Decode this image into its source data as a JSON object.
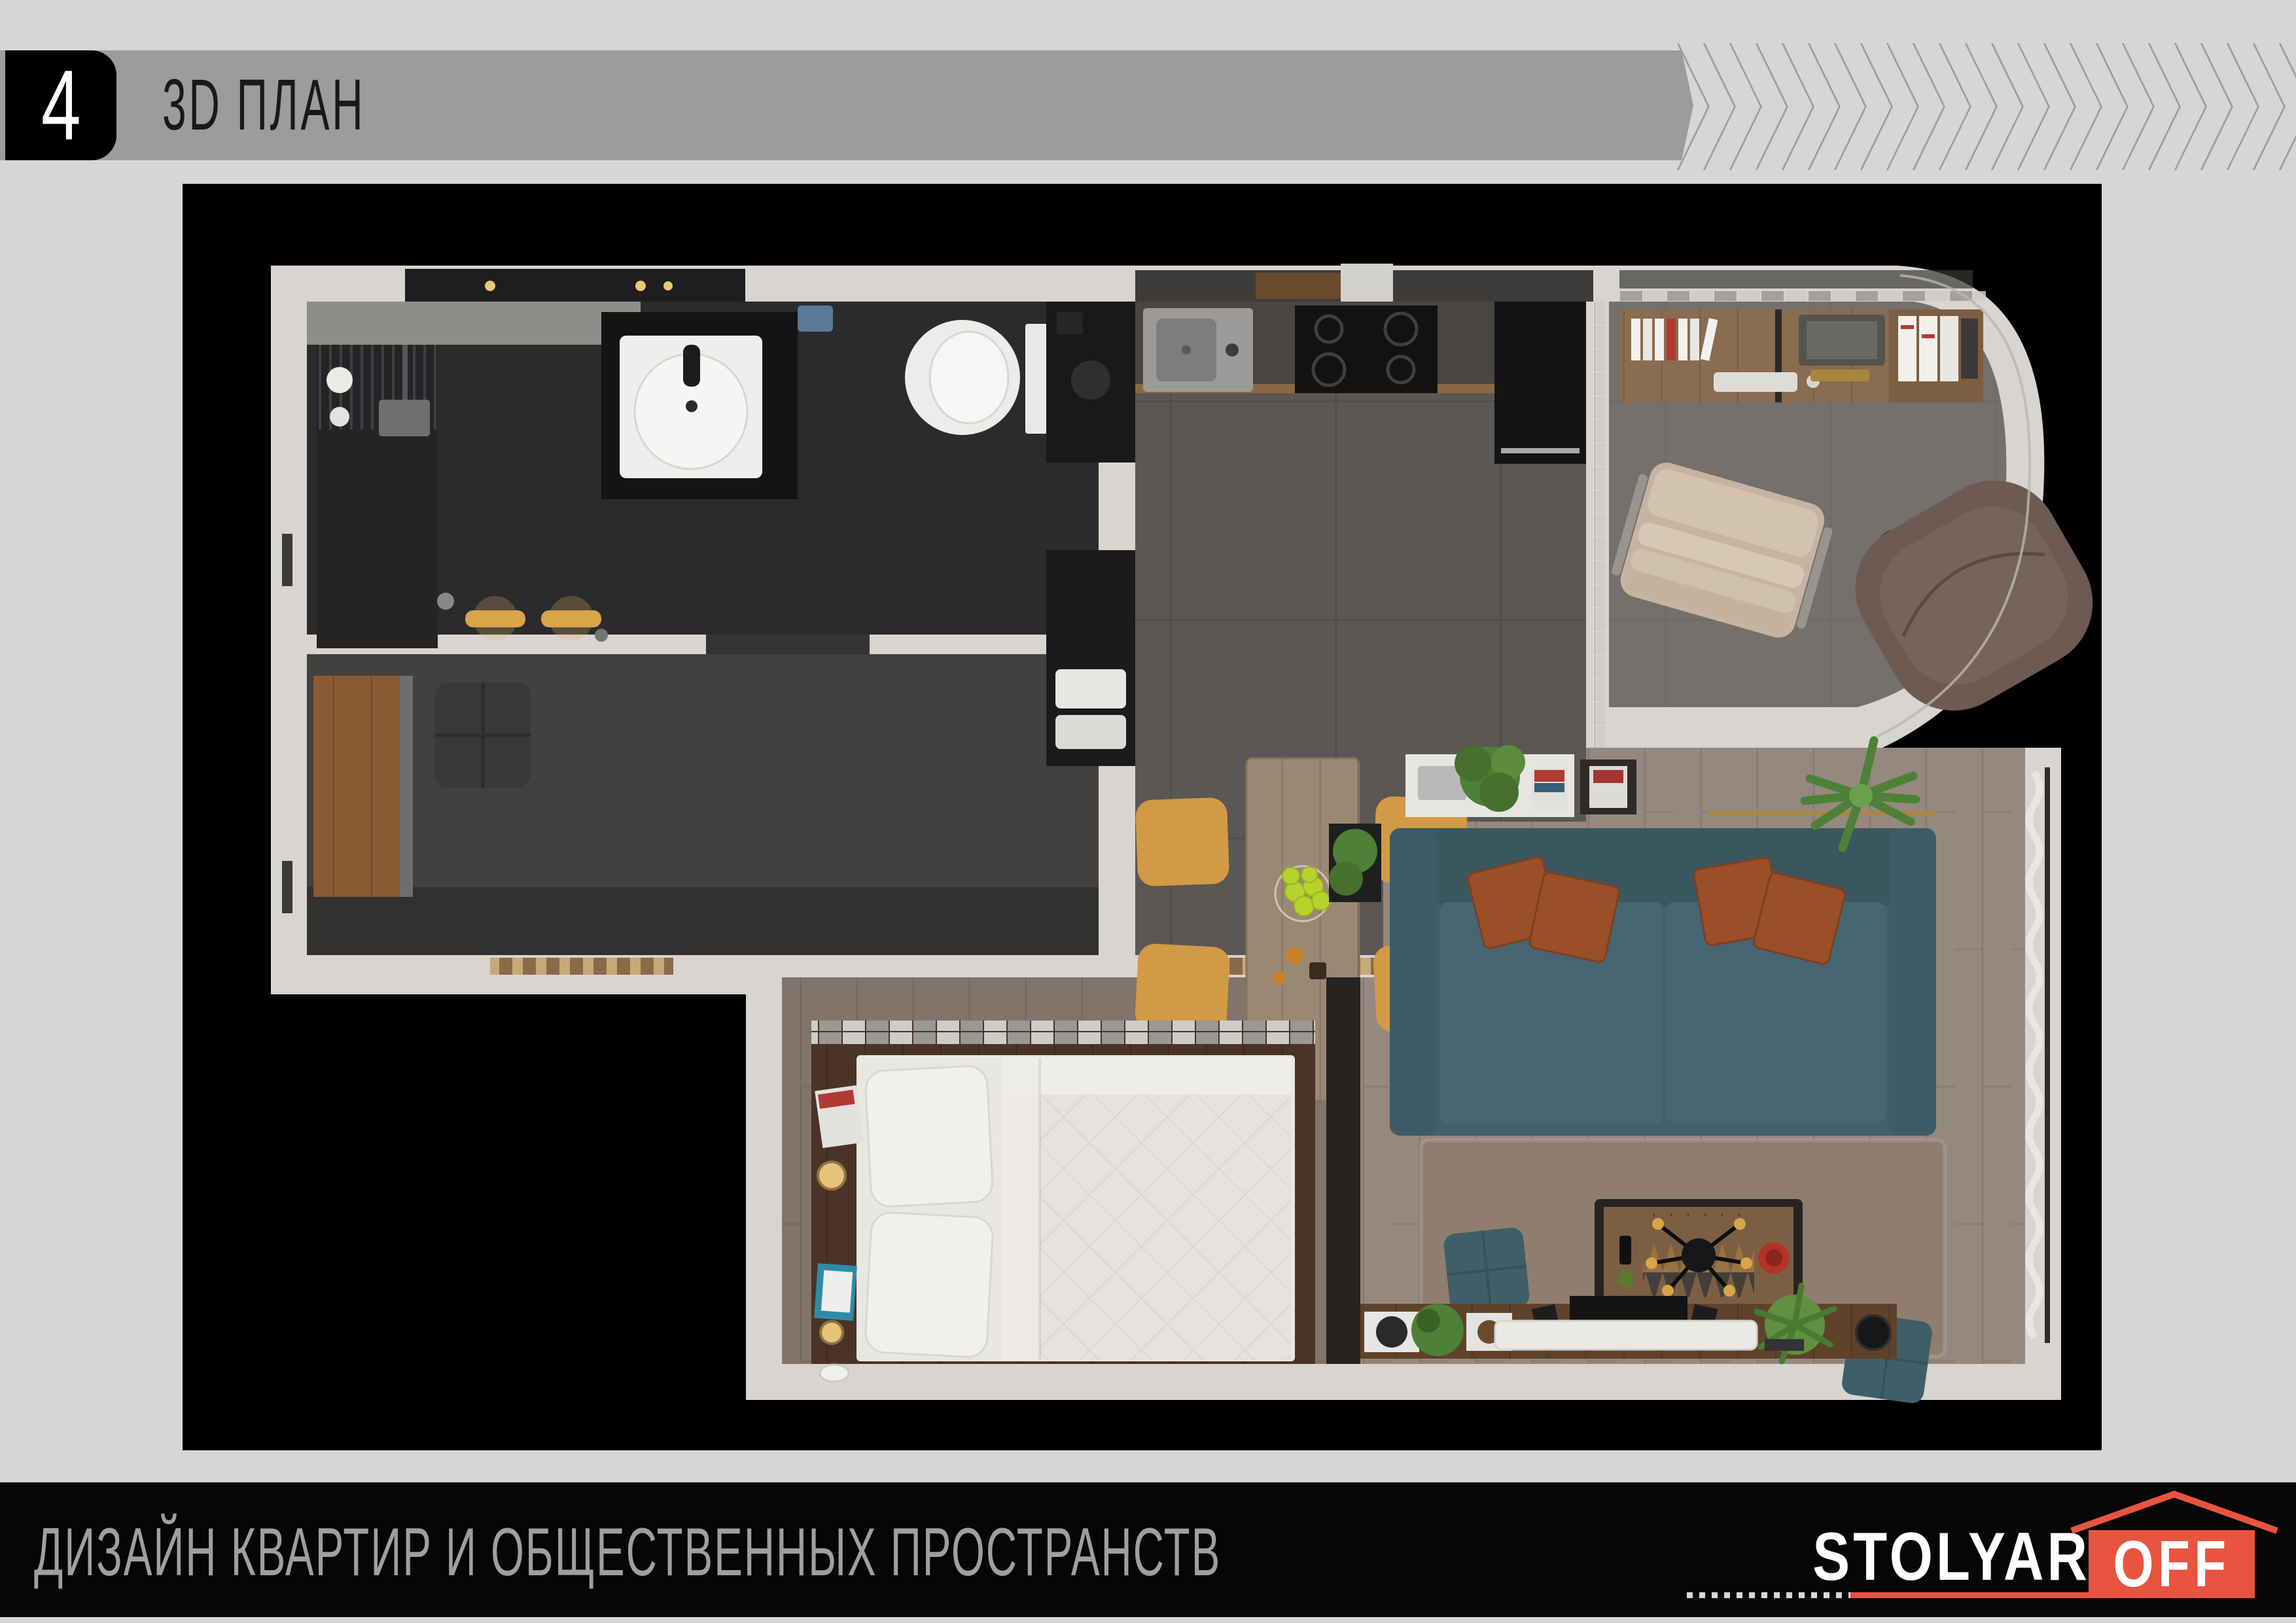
{
  "slide": {
    "number": "4",
    "title": "3D ПЛАН"
  },
  "footer": {
    "tagline": "ДИЗАЙН КВАРТИР И ОБЩЕСТВЕННЫХ ПРОСТРАНСТВ",
    "logo": {
      "name_left": "STOLYAR",
      "name_right": "OFF"
    }
  },
  "colors": {
    "page_bg": "#d6d6d6",
    "header_bar": "#9c9c9c",
    "header_number_bg": "#000000",
    "title_text": "#191919",
    "chevron": "#9d9d9d",
    "footer_bg": "#060606",
    "footer_text": "#9f9f9f",
    "logo_accent": "#e85440",
    "logo_text": "#ffffff",
    "plan_bg": "#000000",
    "wall": "#d8d5d0",
    "tile_floor": "#5a5755",
    "bath_floor": "#2b2a2c",
    "hall_floor": "#434040",
    "office_floor": "#74706b",
    "wood_floor": "#95897f",
    "platform_wood": "#4a3425",
    "bed": "#e9e7e3",
    "sofa": "#41616a",
    "sofa_seat": "#466672",
    "pillow": "#9a4f28",
    "rug": "#8f7e6d",
    "chair": "#d29a44",
    "table_wood": "#9b8873",
    "plant": "#4e8038"
  }
}
